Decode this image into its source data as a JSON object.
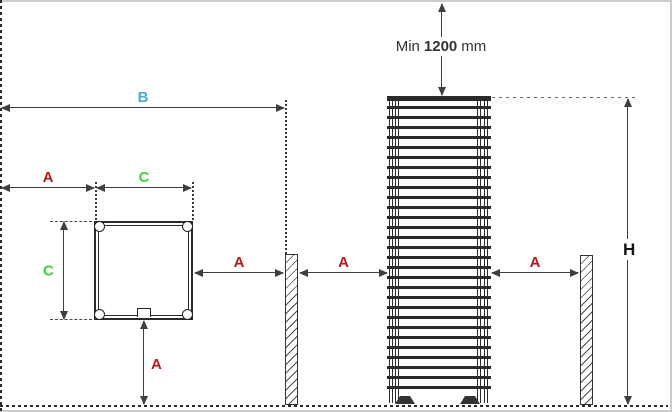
{
  "diagram": {
    "min_clearance": {
      "prefix": "Min",
      "value": "1200",
      "unit": "mm"
    },
    "dims": {
      "b": "B",
      "a_left": "A",
      "c_top": "C",
      "c_side": "C",
      "a_square_to_wall": "A",
      "a_wall_to_heater": "A",
      "a_heater_to_wall": "A",
      "a_bottom": "A",
      "h": "H"
    },
    "colors": {
      "a": "#b8191c",
      "b": "#4aa7df",
      "c": "#3ed23e",
      "h": "#141414",
      "line": "#3f3f3f",
      "text": "#333333"
    }
  }
}
